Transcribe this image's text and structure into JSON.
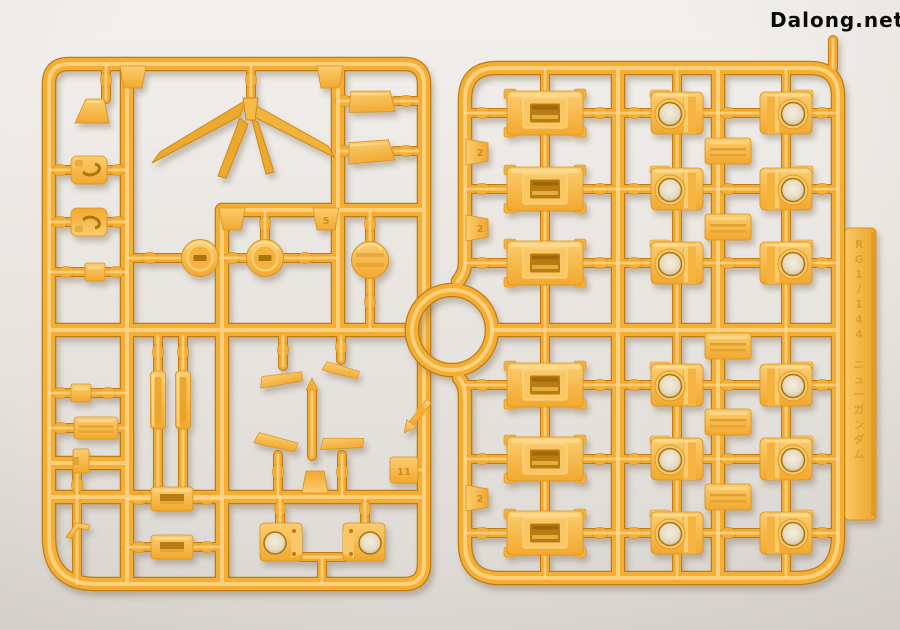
{
  "watermark": {
    "text": "Dalong.net"
  },
  "runner_tag": {
    "text": "RG1/144 ニューガンダム"
  },
  "gate_numbers": {
    "left_rail_top": "2",
    "left_rail_mid": "2",
    "left_rail_bottom": "2",
    "h3_tab": "5",
    "corner_tag": "11"
  },
  "colors": {
    "background_top": "#f2f0ed",
    "background_bottom": "#dcd8d3",
    "plastic_base": "#f4ae34",
    "plastic_highlight": "#ffdf9b",
    "plastic_shadow": "#d8931f",
    "plastic_deep": "#c07c12",
    "part_face_light": "#fbcd70",
    "part_face_dark": "#f2a82e",
    "hole_interior": "#e7dcc4",
    "molded_text": "#cf8c1c",
    "watermark_text": "#0b0b0b"
  }
}
